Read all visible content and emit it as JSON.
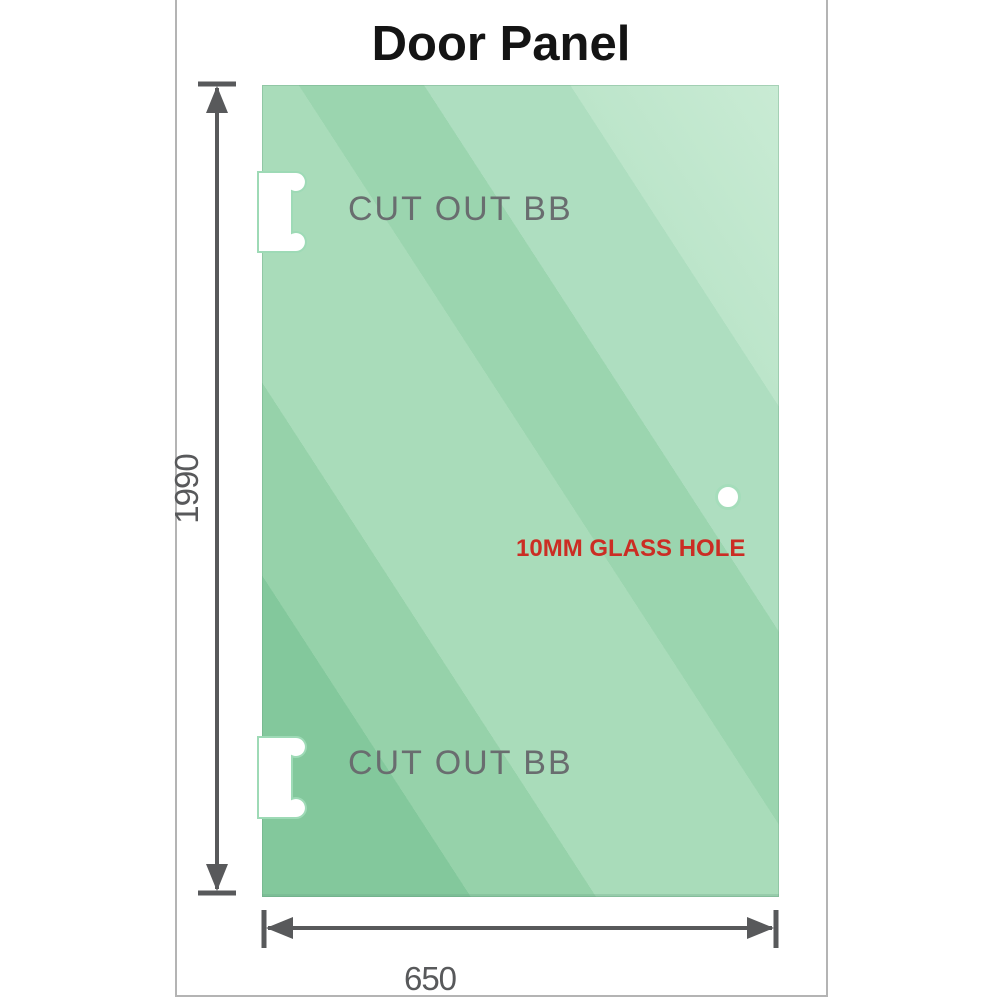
{
  "title": "Door Panel",
  "panel": {
    "top_cutout_label": "CUT OUT BB",
    "bottom_cutout_label": "CUT OUT BB",
    "glass_hole_label": "10MM GLASS HOLE"
  },
  "dimensions": {
    "height_mm": "1990",
    "width_mm": "650"
  },
  "colors": {
    "glass_green_dark": "#83c89c",
    "glass_green_light": "#c9ebd4",
    "cutout_outline_green": "#9edab6",
    "annotation_red": "#cb2d24",
    "cutout_label_gray": "#696d6f",
    "dimension_gray": "#58595b",
    "frame_border_gray": "#b4b4b4",
    "title_black": "#141414"
  }
}
